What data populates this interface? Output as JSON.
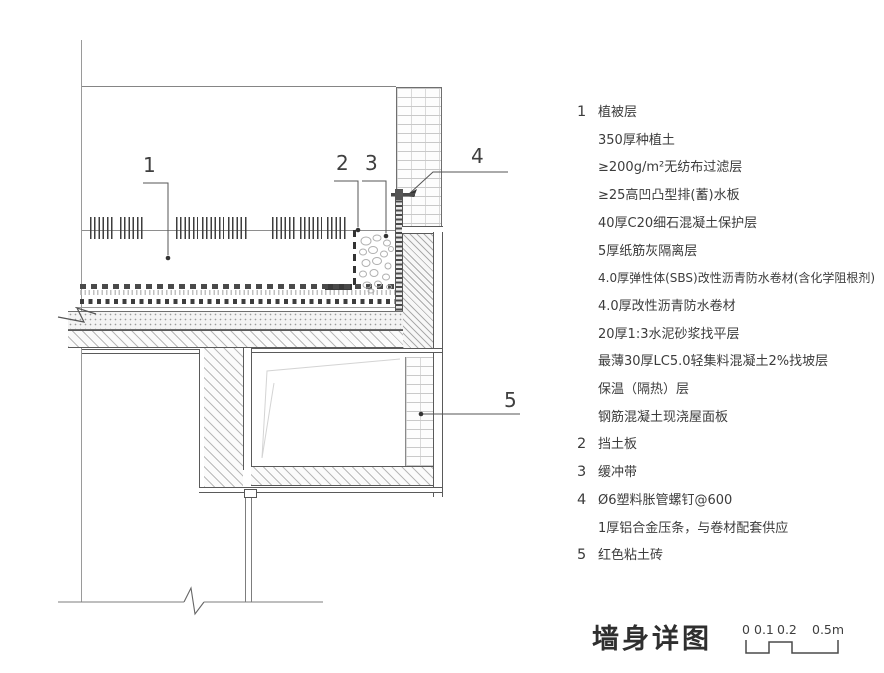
{
  "colors": {
    "line": "#5a5a5a",
    "text": "#3a3a3a",
    "hatch": "#bdbdbd"
  },
  "drawing": {
    "callouts": [
      {
        "label": "1"
      },
      {
        "label": "2"
      },
      {
        "label": "3"
      },
      {
        "label": "4"
      },
      {
        "label": "5"
      }
    ]
  },
  "legend": {
    "items": [
      {
        "num": "1",
        "lines": [
          "植被层",
          "350厚种植土",
          "≥200g/m²无纺布过滤层",
          "≥25高凹凸型排(蓄)水板",
          "40厚C20细石混凝土保护层",
          "5厚纸筋灰隔离层",
          "4.0厚弹性体(SBS)改性沥青防水卷材(含化学阻根剂)",
          "4.0厚改性沥青防水卷材",
          "20厚1:3水泥砂浆找平层",
          "最薄30厚LC5.0轻集料混凝土2%找坡层",
          "保温（隔热）层",
          "钢筋混凝土现浇屋面板"
        ]
      },
      {
        "num": "2",
        "lines": [
          "挡土板"
        ]
      },
      {
        "num": "3",
        "lines": [
          "缓冲带"
        ]
      },
      {
        "num": "4",
        "lines": [
          "Ø6塑料胀管螺钉@600",
          "1厚铝合金压条，与卷材配套供应"
        ]
      },
      {
        "num": "5",
        "lines": [
          "红色粘土砖"
        ]
      }
    ]
  },
  "footer": {
    "title": "墙身详图",
    "scale_labels": [
      "0",
      "0.1",
      "0.2",
      "0.5m"
    ]
  }
}
